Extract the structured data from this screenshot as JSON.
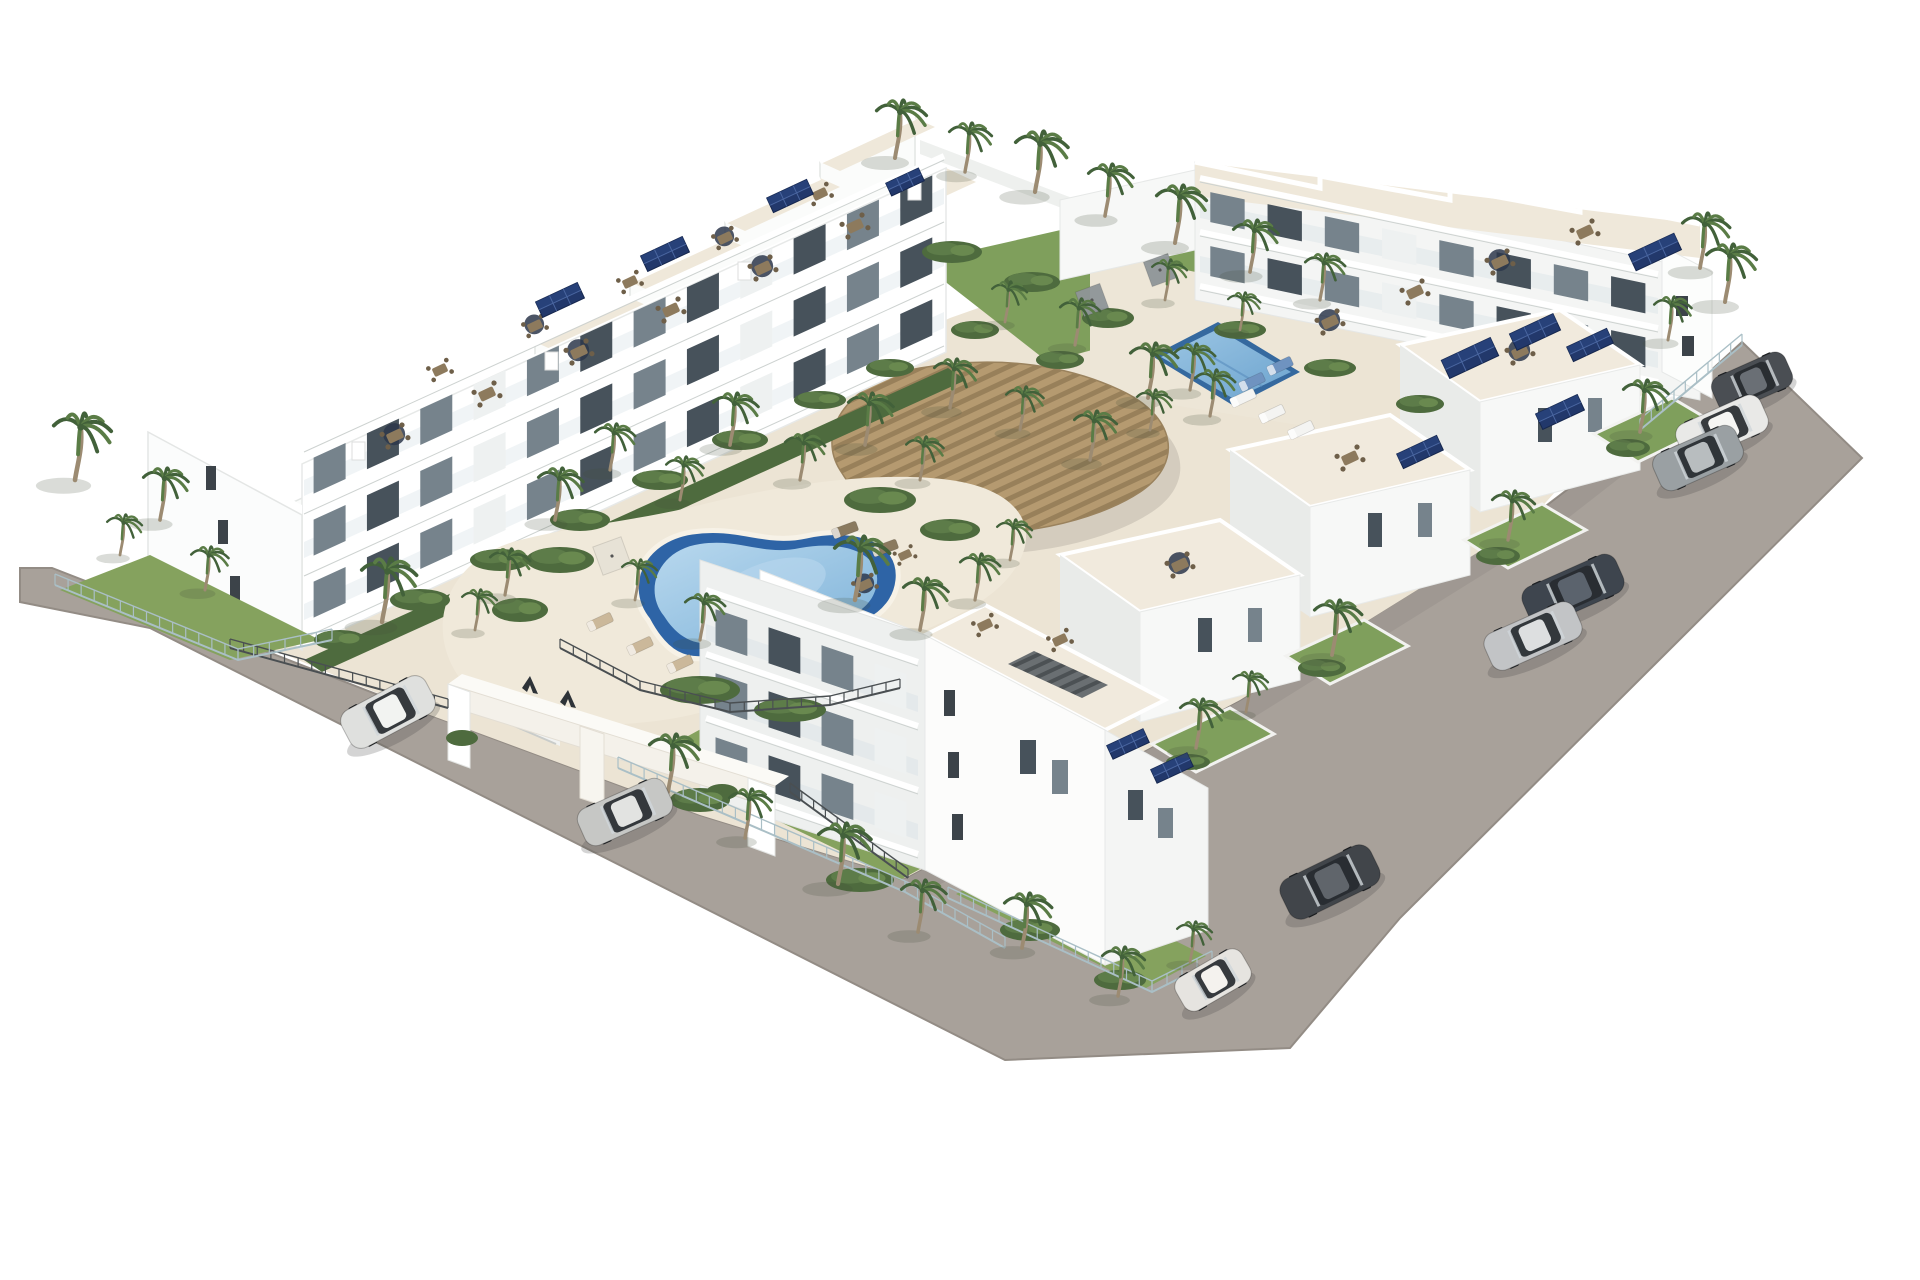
{
  "scene": {
    "description": "Aerial 3D architectural rendering of a white Mediterranean apartment complex: rows of modern white blocks with rooftop terraces, dining sets and solar panels, a central kidney-shaped swimming pool, a rectangular lap pool, a curved wooden pergola, palm-tree gardens, perimeter asphalt roads with parked cars and a white gated entrance portal marked with two dark triangular logo glyphs.",
    "image_type": "photorealistic real-estate render",
    "visible_text": ""
  },
  "palette": {
    "background": "#ffffff",
    "road": "#a8a19a",
    "road_edge": "#938c85",
    "building_white": "#fdfdfc",
    "building_shade": "#e9ebea",
    "terrace_cream": "#efe8da",
    "deck_cream": "#f0e9da",
    "glass_dark": "#47525b",
    "glass_mid": "#76838c",
    "lawn_green": "#85a25e",
    "garden_green": "#4e6b3e",
    "palm_green": "#5a7c46",
    "palm_dark": "#42613a",
    "palm_trunk": "#9c8b72",
    "pool_rim": "#2e64a6",
    "pool_water_light": "#b8d8ee",
    "pool_water": "#7fb3d9",
    "pergola_wood": "#b59a70",
    "pergola_gap": "#98805a",
    "solar_navy": "#22386b",
    "fence_metal": "#4a4f52",
    "fence_glass": "#aabfc6",
    "gate_glyph": "#2e3338"
  },
  "counts": {
    "cars_total": 9,
    "swimming_pools": 2,
    "entrance_gates": 1
  },
  "cars": [
    {
      "name": "dark-gray-hatchback",
      "color": "#4a4e53",
      "roof": "#6a6f75",
      "x": 1752,
      "y": 382,
      "angle": -24,
      "len": 80,
      "wid": 38
    },
    {
      "name": "white-suv",
      "color": "#e9e9e7",
      "roof": "#f6f6f4",
      "x": 1722,
      "y": 428,
      "angle": -24,
      "len": 92,
      "wid": 40
    },
    {
      "name": "gray-crossover",
      "color": "#9aa0a3",
      "roof": "#b8bdbf",
      "x": 1698,
      "y": 458,
      "angle": -24,
      "len": 90,
      "wid": 40
    },
    {
      "name": "dark-blue-sedan",
      "color": "#3e454e",
      "roof": "#5b636d",
      "x": 1573,
      "y": 590,
      "angle": -24,
      "len": 102,
      "wid": 42
    },
    {
      "name": "silver-sedan",
      "color": "#c2c4c6",
      "roof": "#dddfe0",
      "x": 1533,
      "y": 636,
      "angle": -24,
      "len": 98,
      "wid": 40
    },
    {
      "name": "dark-suv",
      "color": "#41454a",
      "roof": "#60656b",
      "x": 1330,
      "y": 882,
      "angle": -26,
      "len": 100,
      "wid": 44
    },
    {
      "name": "white-fiat-500",
      "color": "#e6e4e0",
      "roof": "#f4f2ee",
      "x": 1213,
      "y": 980,
      "angle": -30,
      "len": 76,
      "wid": 38
    },
    {
      "name": "white-suv-entrance",
      "color": "#dfe0de",
      "roof": "#f2f3f1",
      "x": 388,
      "y": 712,
      "angle": -28,
      "len": 95,
      "wid": 42
    },
    {
      "name": "silver-sedan-entrance",
      "color": "#c6c7c5",
      "roof": "#e2e3e1",
      "x": 625,
      "y": 812,
      "angle": -24,
      "len": 95,
      "wid": 40
    }
  ],
  "palms": [
    [
      75,
      480,
      1.15
    ],
    [
      160,
      520,
      0.9
    ],
    [
      205,
      590,
      0.75
    ],
    [
      120,
      555,
      0.7
    ],
    [
      382,
      622,
      1.1
    ],
    [
      895,
      158,
      1.0
    ],
    [
      965,
      172,
      0.85
    ],
    [
      1035,
      192,
      1.05
    ],
    [
      1105,
      216,
      0.9
    ],
    [
      1175,
      243,
      1.0
    ],
    [
      1250,
      272,
      0.9
    ],
    [
      1320,
      300,
      0.8
    ],
    [
      1700,
      268,
      0.95
    ],
    [
      1668,
      340,
      0.75
    ],
    [
      1725,
      302,
      1.0
    ],
    [
      1640,
      432,
      0.9
    ],
    [
      1508,
      540,
      0.85
    ],
    [
      1332,
      655,
      0.95
    ],
    [
      1196,
      748,
      0.85
    ],
    [
      1246,
      712,
      0.7
    ],
    [
      555,
      520,
      0.9
    ],
    [
      610,
      470,
      0.8
    ],
    [
      680,
      500,
      0.75
    ],
    [
      730,
      445,
      0.9
    ],
    [
      800,
      480,
      0.8
    ],
    [
      865,
      445,
      0.9
    ],
    [
      920,
      480,
      0.75
    ],
    [
      855,
      600,
      1.1
    ],
    [
      920,
      630,
      0.9
    ],
    [
      975,
      600,
      0.8
    ],
    [
      1010,
      560,
      0.7
    ],
    [
      700,
      640,
      0.8
    ],
    [
      635,
      600,
      0.7
    ],
    [
      950,
      408,
      0.85
    ],
    [
      1020,
      430,
      0.75
    ],
    [
      1090,
      460,
      0.85
    ],
    [
      1150,
      430,
      0.7
    ],
    [
      1190,
      390,
      0.8
    ],
    [
      1075,
      345,
      0.8
    ],
    [
      1005,
      322,
      0.7
    ],
    [
      1148,
      398,
      0.95
    ],
    [
      1210,
      416,
      0.8
    ],
    [
      1165,
      300,
      0.7
    ],
    [
      1240,
      330,
      0.65
    ],
    [
      668,
      792,
      1.0
    ],
    [
      745,
      838,
      0.85
    ],
    [
      838,
      884,
      1.05
    ],
    [
      918,
      932,
      0.9
    ],
    [
      1022,
      948,
      0.95
    ],
    [
      1118,
      996,
      0.85
    ],
    [
      1190,
      962,
      0.7
    ],
    [
      505,
      595,
      0.8
    ],
    [
      475,
      630,
      0.7
    ]
  ],
  "shrubs": [
    [
      340,
      640,
      26,
      10
    ],
    [
      420,
      600,
      30,
      11
    ],
    [
      500,
      560,
      30,
      11
    ],
    [
      580,
      520,
      30,
      11
    ],
    [
      660,
      480,
      28,
      10
    ],
    [
      740,
      440,
      28,
      10
    ],
    [
      820,
      400,
      26,
      9
    ],
    [
      890,
      368,
      24,
      9
    ],
    [
      560,
      560,
      34,
      13
    ],
    [
      520,
      610,
      28,
      12
    ],
    [
      880,
      500,
      36,
      13
    ],
    [
      950,
      530,
      30,
      11
    ],
    [
      700,
      690,
      40,
      14
    ],
    [
      790,
      710,
      36,
      12
    ],
    [
      700,
      800,
      30,
      12
    ],
    [
      860,
      880,
      34,
      12
    ],
    [
      1030,
      930,
      30,
      11
    ],
    [
      1120,
      980,
      26,
      10
    ],
    [
      1628,
      448,
      22,
      9
    ],
    [
      1498,
      556,
      22,
      9
    ],
    [
      1322,
      668,
      24,
      9
    ],
    [
      1188,
      762,
      22,
      8
    ],
    [
      952,
      252,
      30,
      11
    ],
    [
      1032,
      282,
      28,
      10
    ],
    [
      1108,
      318,
      26,
      10
    ],
    [
      975,
      330,
      24,
      9
    ],
    [
      1060,
      360,
      24,
      9
    ],
    [
      1240,
      330,
      26,
      9
    ],
    [
      1330,
      368,
      26,
      9
    ],
    [
      1420,
      404,
      24,
      9
    ]
  ],
  "roof_tables": [
    [
      395,
      436,
      1,
      1
    ],
    [
      487,
      394,
      1,
      0
    ],
    [
      579,
      352,
      1,
      1
    ],
    [
      671,
      310,
      1,
      0
    ],
    [
      763,
      268,
      1,
      1
    ],
    [
      855,
      226,
      1,
      0
    ],
    [
      440,
      370,
      0.9,
      0
    ],
    [
      535,
      326,
      0.9,
      1
    ],
    [
      630,
      282,
      0.9,
      0
    ],
    [
      725,
      238,
      0.9,
      1
    ],
    [
      820,
      194,
      0.9,
      0
    ],
    [
      1330,
      322,
      1,
      1
    ],
    [
      1415,
      292,
      1,
      0
    ],
    [
      1500,
      262,
      1,
      1
    ],
    [
      1585,
      232,
      1,
      0
    ],
    [
      1520,
      352,
      1,
      1
    ],
    [
      1350,
      458,
      1,
      0
    ],
    [
      1180,
      565,
      1,
      1
    ],
    [
      1060,
      640,
      0.9,
      0
    ],
    [
      985,
      625,
      0.9,
      0
    ],
    [
      865,
      585,
      0.9,
      1
    ],
    [
      905,
      555,
      0.8,
      0
    ]
  ],
  "solar_arrays": [
    [
      560,
      300,
      46,
      17
    ],
    [
      665,
      254,
      46,
      17
    ],
    [
      790,
      196,
      44,
      16
    ],
    [
      1655,
      252,
      50,
      18
    ],
    [
      1470,
      358,
      54,
      20
    ],
    [
      1535,
      332,
      48,
      18
    ],
    [
      1560,
      412,
      46,
      17
    ],
    [
      1590,
      345,
      44,
      16
    ],
    [
      1420,
      452,
      44,
      16
    ],
    [
      1128,
      744,
      40,
      15
    ],
    [
      1172,
      768,
      40,
      15
    ],
    [
      905,
      182,
      36,
      14
    ]
  ],
  "loungers": [
    [
      600,
      622,
      -25,
      "#cbb89a"
    ],
    [
      640,
      646,
      -25,
      "#cbb89a"
    ],
    [
      680,
      664,
      -25,
      "#cbb89a"
    ],
    [
      845,
      530,
      -20,
      "#8a7a5f"
    ],
    [
      885,
      548,
      -20,
      "#8a7a5f"
    ],
    [
      1243,
      398,
      -25,
      "#f4f4f2"
    ],
    [
      1272,
      414,
      -25,
      "#f4f4f2"
    ],
    [
      1301,
      430,
      -25,
      "#f4f4f2"
    ],
    [
      1252,
      382,
      -25,
      "#6f93c0"
    ],
    [
      1280,
      366,
      -25,
      "#6f93c0"
    ]
  ],
  "canopies": [
    [
      612,
      556,
      30,
      "#e7e2d6"
    ],
    [
      1092,
      300,
      26,
      "#8f9598"
    ],
    [
      1160,
      270,
      26,
      "#8f9598"
    ]
  ],
  "facade_strips": [
    {
      "x0": 304,
      "y0": 642,
      "x1": 944,
      "y1": 350,
      "floors": 3,
      "fh": 62,
      "bays": 12,
      "gh": 36
    },
    {
      "x0": 1200,
      "y0": 294,
      "x1": 1658,
      "y1": 390,
      "floors": 2,
      "fh": 54,
      "bays": 8,
      "gh": 30
    },
    {
      "x0": 706,
      "y0": 790,
      "x1": 918,
      "y1": 862,
      "floors": 3,
      "fh": 64,
      "bays": 4,
      "gh": 36
    }
  ],
  "fences_metal": [
    [
      [
        230,
        648
      ],
      [
        448,
        708
      ]
    ],
    [
      [
        790,
        792
      ],
      [
        908,
        878
      ]
    ],
    [
      [
        560,
        648
      ],
      [
        640,
        690
      ],
      [
        730,
        712
      ],
      [
        830,
        705
      ],
      [
        900,
        688
      ]
    ]
  ],
  "fences_glass": [
    [
      [
        55,
        585
      ],
      [
        238,
        660
      ],
      [
        332,
        640
      ]
    ],
    [
      [
        618,
        768
      ],
      [
        905,
        892
      ],
      [
        1005,
        948
      ]
    ],
    [
      [
        948,
        898
      ],
      [
        1152,
        992
      ],
      [
        1212,
        962
      ]
    ],
    [
      [
        1640,
        430
      ],
      [
        1742,
        345
      ]
    ]
  ],
  "gate": {
    "glyphs": 2,
    "glyph_color": "#2e3338"
  }
}
